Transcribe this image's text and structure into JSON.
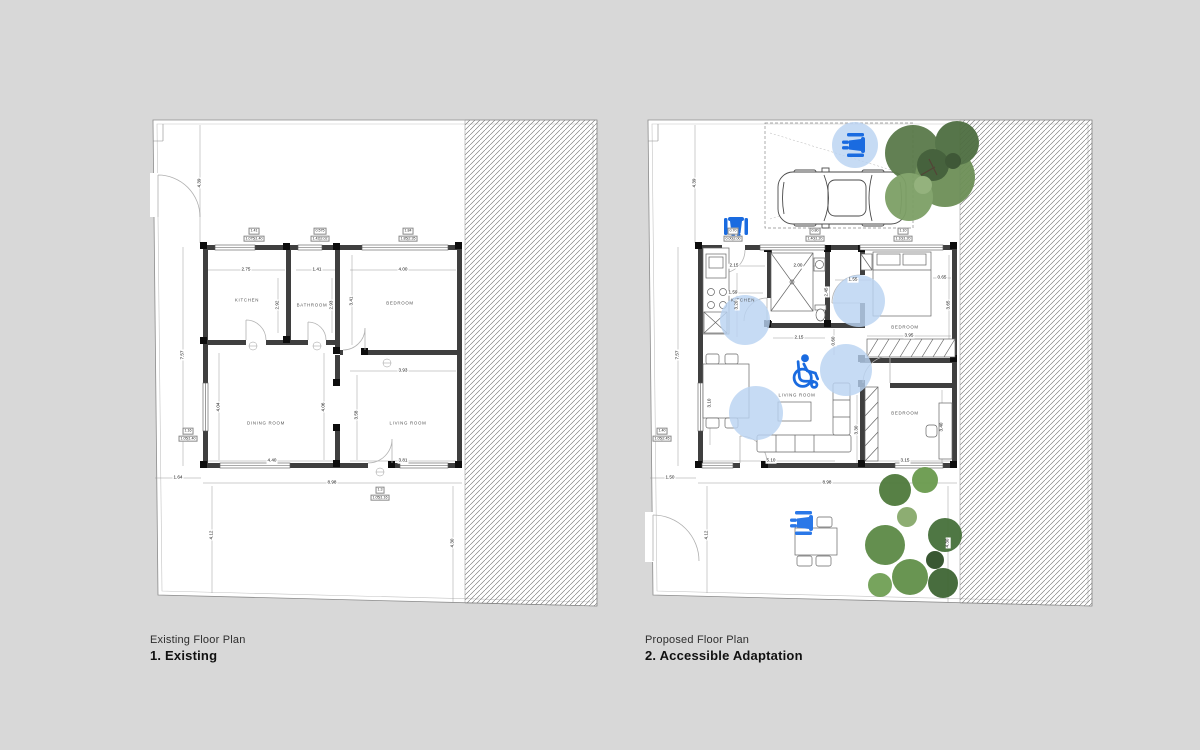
{
  "colors": {
    "background": "#d8d8d8",
    "paper": "#ffffff",
    "wall": "#3f3f3f",
    "column": "#0d0d0d",
    "accent_blue": "#1a6be0",
    "turning_circle_blue": "#b9d3f2",
    "hatch": "#6b6b6b",
    "tree_green": "#5a7a4a"
  },
  "captions": {
    "left": {
      "title": "Existing Floor Plan",
      "subtitle": "1. Existing"
    },
    "right": {
      "title": "Proposed Floor Plan",
      "subtitle": "2. Accessible Adaptation"
    }
  },
  "plans": {
    "left": {
      "rooms": [
        {
          "t": "KITCHEN",
          "x": 97,
          "y": 185
        },
        {
          "t": "BATHROOM",
          "x": 162,
          "y": 190
        },
        {
          "t": "BEDROOM",
          "x": 250,
          "y": 188
        },
        {
          "t": "DINING ROOM",
          "x": 116,
          "y": 308
        },
        {
          "t": "LIVING ROOM",
          "x": 258,
          "y": 308
        }
      ],
      "dims": [
        {
          "t": "4.39",
          "x": 50,
          "y": 68,
          "r": 1
        },
        {
          "t": "7.57",
          "x": 33,
          "y": 240,
          "r": 1
        },
        {
          "t": "2.75",
          "x": 96,
          "y": 155
        },
        {
          "t": "1.41",
          "x": 167,
          "y": 155
        },
        {
          "t": "4.00",
          "x": 253,
          "y": 155
        },
        {
          "t": "2.92",
          "x": 128,
          "y": 190,
          "r": 1
        },
        {
          "t": "2.93",
          "x": 182,
          "y": 190,
          "r": 1
        },
        {
          "t": "3.41",
          "x": 202,
          "y": 186,
          "r": 1
        },
        {
          "t": "3.93",
          "x": 253,
          "y": 256
        },
        {
          "t": "4.04",
          "x": 69,
          "y": 292,
          "r": 1
        },
        {
          "t": "4.06",
          "x": 174,
          "y": 292,
          "r": 1
        },
        {
          "t": "3.58",
          "x": 207,
          "y": 300,
          "r": 1
        },
        {
          "t": "4.40",
          "x": 122,
          "y": 346
        },
        {
          "t": "3.81",
          "x": 253,
          "y": 346
        },
        {
          "t": "1.64",
          "x": 28,
          "y": 363
        },
        {
          "t": "8.98",
          "x": 182,
          "y": 368
        },
        {
          "t": "4.12",
          "x": 62,
          "y": 420,
          "r": 1
        },
        {
          "t": "4.30",
          "x": 303,
          "y": 428,
          "r": 1
        }
      ],
      "window_tags": [
        {
          "top": "1.41",
          "bot": "1.075|1.40",
          "x": 104,
          "y": 127
        },
        {
          "top": "0.575",
          "bot": "1.42|2.02",
          "x": 170,
          "y": 127
        },
        {
          "top": "1.84",
          "bot": "1.85|2.35",
          "x": 258,
          "y": 127
        },
        {
          "top": "1.16",
          "bot": "1.05|1.40",
          "x": 38,
          "y": 327
        },
        {
          "top": "1.3",
          "bot": "1.05|1.16",
          "x": 230,
          "y": 386
        }
      ]
    },
    "right": {
      "rooms": [
        {
          "t": "KITCHEN",
          "x": 98,
          "y": 185
        },
        {
          "t": "BEDROOM",
          "x": 260,
          "y": 212
        },
        {
          "t": "LIVING ROOM",
          "x": 152,
          "y": 280
        },
        {
          "t": "BEDROOM",
          "x": 260,
          "y": 298
        }
      ],
      "dims": [
        {
          "t": "4.39",
          "x": 50,
          "y": 68,
          "r": 1
        },
        {
          "t": "7.57",
          "x": 33,
          "y": 240,
          "r": 1
        },
        {
          "t": "2.15",
          "x": 89,
          "y": 151
        },
        {
          "t": "2.00",
          "x": 153,
          "y": 151
        },
        {
          "t": "1.59",
          "x": 88,
          "y": 178
        },
        {
          "t": "3.20",
          "x": 92,
          "y": 190,
          "r": 1
        },
        {
          "t": "1.55",
          "x": 208,
          "y": 165
        },
        {
          "t": "0.65",
          "x": 297,
          "y": 163
        },
        {
          "t": "2.45",
          "x": 182,
          "y": 177,
          "r": 1
        },
        {
          "t": "3.65",
          "x": 304,
          "y": 190,
          "r": 1
        },
        {
          "t": "2.15",
          "x": 154,
          "y": 223
        },
        {
          "t": "0.60",
          "x": 189,
          "y": 226,
          "r": 1
        },
        {
          "t": "3.95",
          "x": 264,
          "y": 221
        },
        {
          "t": "3.10",
          "x": 65,
          "y": 288,
          "r": 1
        },
        {
          "t": "3.30",
          "x": 212,
          "y": 315,
          "r": 1
        },
        {
          "t": "3.40",
          "x": 297,
          "y": 312,
          "r": 1
        },
        {
          "t": "5.10",
          "x": 126,
          "y": 346
        },
        {
          "t": "3.15",
          "x": 260,
          "y": 346
        },
        {
          "t": "1.50",
          "x": 25,
          "y": 363
        },
        {
          "t": "8.98",
          "x": 182,
          "y": 368
        },
        {
          "t": "4.12",
          "x": 62,
          "y": 420,
          "r": 1
        },
        {
          "t": "4.30",
          "x": 303,
          "y": 428,
          "r": 1
        }
      ],
      "window_tags": [
        {
          "top": "0.70",
          "bot": "0.00|2.00",
          "x": 88,
          "y": 127
        },
        {
          "top": "0.80",
          "bot": "1.40|1.20",
          "x": 170,
          "y": 127
        },
        {
          "top": "1.10",
          "bot": "1.10|1.20",
          "x": 258,
          "y": 127
        },
        {
          "top": "1.40",
          "bot": "1.05|2.45",
          "x": 17,
          "y": 327
        }
      ]
    }
  }
}
